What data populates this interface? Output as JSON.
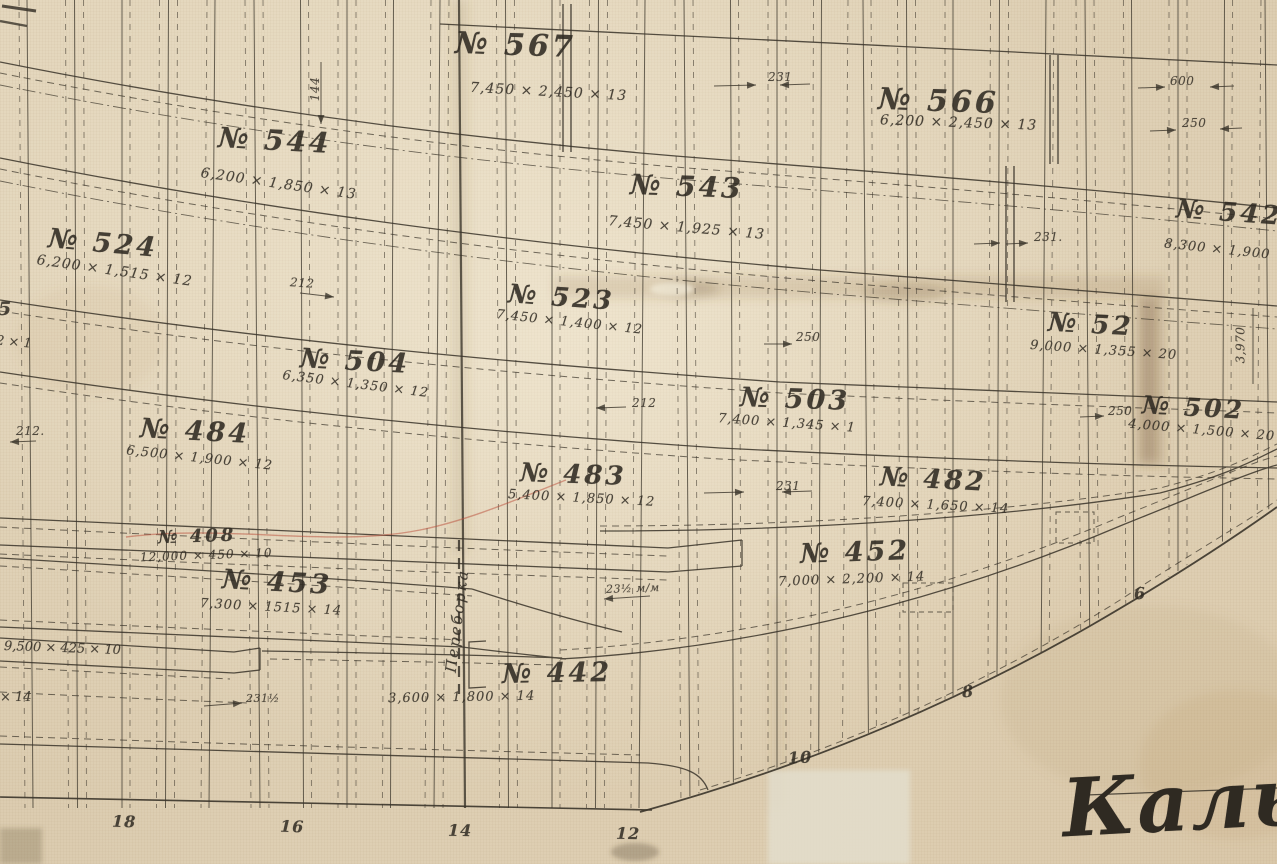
{
  "colors": {
    "paper": "#e4d7bd",
    "ink": "#2f2a22",
    "stamp_red": "#c15a44"
  },
  "plates": [
    {
      "number": "№ 567",
      "size": "7,450 × 2,450 × 13"
    },
    {
      "number": "№ 566",
      "size": "6,200 × 2,450 × 13"
    },
    {
      "number": "№ 544",
      "size": "6,200 × 1,850 × 13"
    },
    {
      "number": "№ 543",
      "size": "7,450 × 1,925 × 13"
    },
    {
      "number": "№ 542",
      "size": "8,300 × 1,900"
    },
    {
      "number": "№ 524",
      "size": "6,200 × 1,515 × 12"
    },
    {
      "number": "№ 523",
      "size": "7,450 × 1,400 × 12"
    },
    {
      "number": "№ 52",
      "size": "9,000 × 1,355 × 20"
    },
    {
      "number": "№ 504",
      "size": "6,350 × 1,350 × 12"
    },
    {
      "number": "№ 503",
      "size": "7,400 × 1,345 × 1"
    },
    {
      "number": "№ 502",
      "size": "4,000 × 1,500 × 20"
    },
    {
      "number": "№ 484",
      "size": "6,500 × 1,900 × 12"
    },
    {
      "number": "№ 483",
      "size": "5,400 × 1,850 × 12"
    },
    {
      "number": "№ 482",
      "size": "7,400 × 1,650 × 14"
    },
    {
      "number": "№ 408",
      "size": "12,000 × 450 × 10"
    },
    {
      "number": "№ 453",
      "size": "7,300 × 1515 × 14"
    },
    {
      "number": "№ 452",
      "size": "7,000 × 2,200 × 14"
    },
    {
      "number": "№ 442",
      "size": "3,600 × 1,800 × 14"
    }
  ],
  "measurements": [
    "144",
    "231",
    "600",
    "250",
    "231.",
    "212",
    "250",
    "3,970",
    "212",
    "250",
    "212.",
    "231",
    "23½ м/м",
    "231½"
  ],
  "stations": [
    "18",
    "16",
    "14",
    "12",
    "10",
    "8",
    "6"
  ],
  "edge_texts": [
    "5",
    "2 × 1",
    "9,500 × 425 × 10",
    "× 14"
  ],
  "annotations": {
    "bulkhead": "Переборка",
    "stamp": "Кальки"
  }
}
